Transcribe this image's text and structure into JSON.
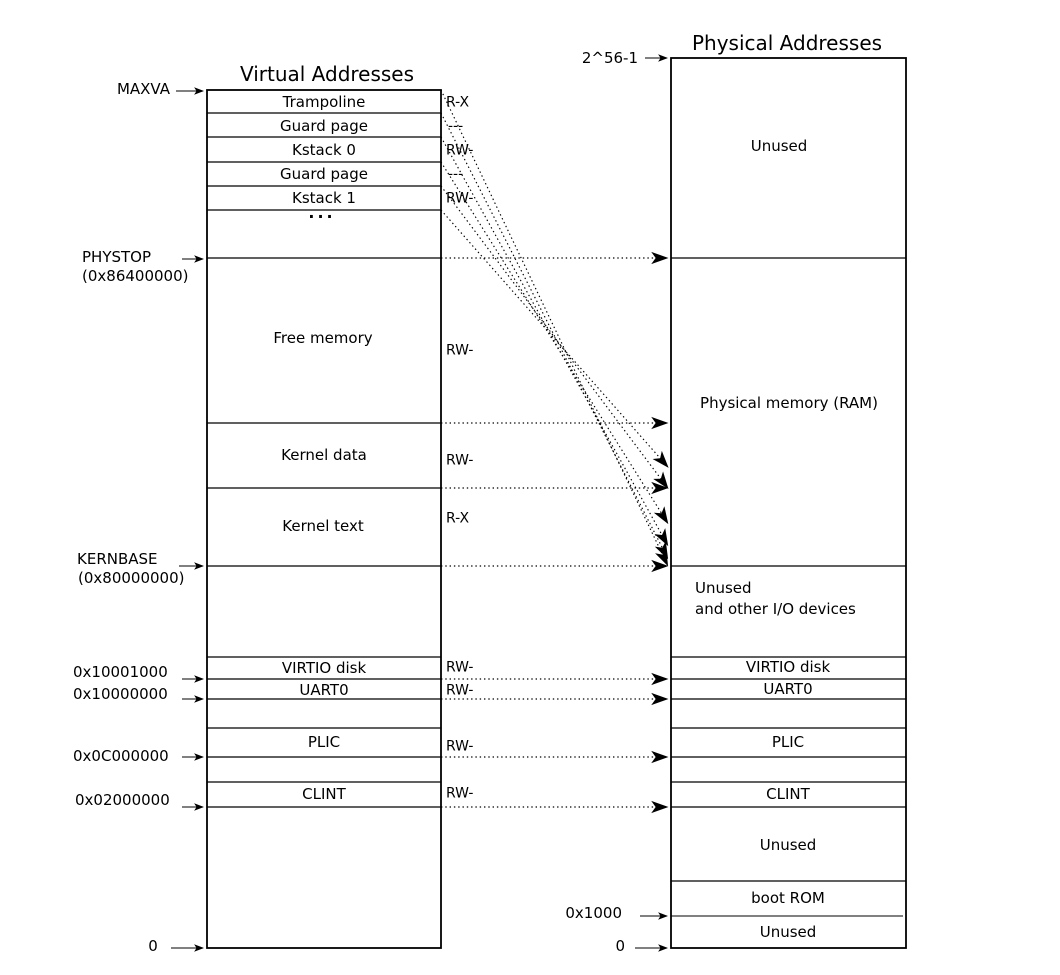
{
  "colors": {
    "ink": "#000000",
    "background": "#ffffff"
  },
  "left_column": {
    "title": "Virtual Addresses",
    "rows": {
      "trampoline": "Trampoline",
      "guard_page_1": "Guard page",
      "kstack0": "Kstack 0",
      "guard_page_2": "Guard page",
      "kstack1": "Kstack 1",
      "ellipsis": "...",
      "free_memory": "Free memory",
      "kernel_data": "Kernel data",
      "kernel_text": "Kernel text",
      "virtio_disk": "VIRTIO disk",
      "uart0": "UART0",
      "plic": "PLIC",
      "clint": "CLINT"
    },
    "permissions": {
      "trampoline": "R-X",
      "guard_page_1": "---",
      "kstack0": "RW-",
      "guard_page_2": "---",
      "kstack1": "RW-",
      "free_memory": "RW-",
      "kernel_data": "RW-",
      "kernel_text": "R-X",
      "virtio_disk": "RW-",
      "uart0": "RW-",
      "plic": "RW-",
      "clint": "RW-"
    },
    "addresses": {
      "maxva": "MAXVA",
      "phystop": "PHYSTOP",
      "phystop_hex": "(0x86400000)",
      "kernbase": "KERNBASE",
      "kernbase_hex": "(0x80000000)",
      "virtio_disk": "0x10001000",
      "uart0": "0x10000000",
      "plic": "0x0C000000",
      "clint": "0x02000000",
      "zero": "0"
    }
  },
  "right_column": {
    "title": "Physical Addresses",
    "regions": {
      "unused_top": "Unused",
      "ram": "Physical memory (RAM)",
      "unused_io_line1": "Unused",
      "unused_io_line2": "and other I/O devices",
      "virtio_disk": "VIRTIO disk",
      "uart0": "UART0",
      "plic": "PLIC",
      "clint": "CLINT",
      "unused_middle": "Unused",
      "boot_rom": "boot ROM",
      "unused_bottom": "Unused"
    },
    "addresses": {
      "top": "2^56-1",
      "boot_rom": "0x1000",
      "zero": "0"
    }
  }
}
